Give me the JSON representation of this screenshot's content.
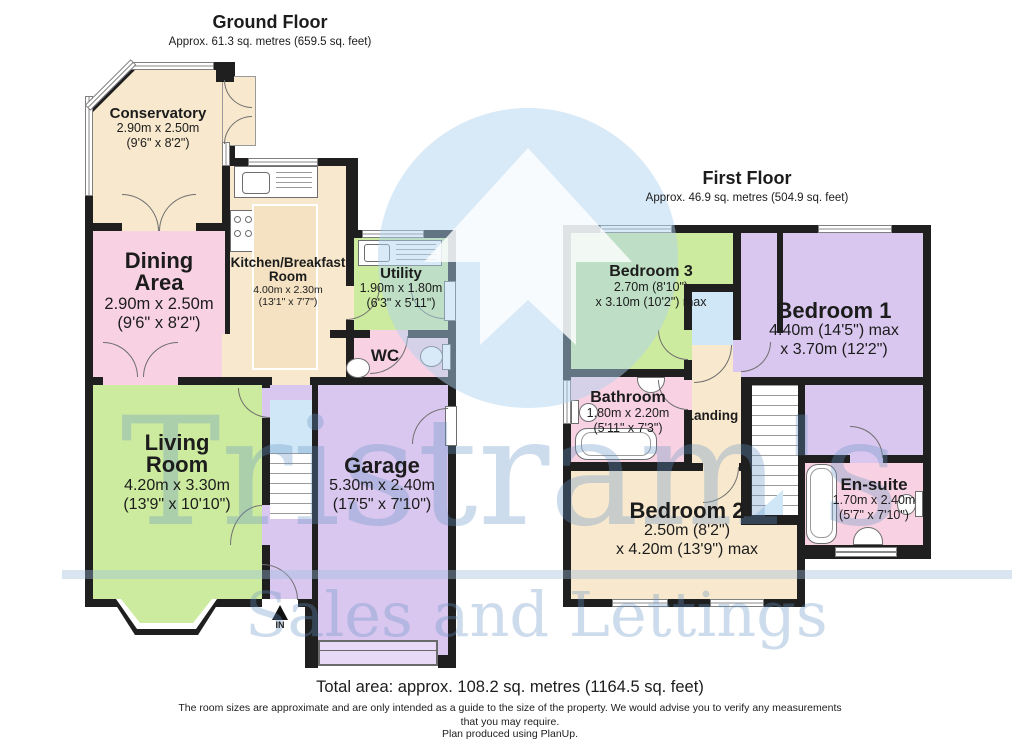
{
  "ground_floor": {
    "title": "Ground Floor",
    "subtitle": "Approx. 61.3 sq. metres (659.5 sq. feet)",
    "entrance_label": "IN",
    "rooms": {
      "conservatory": {
        "name": "Conservatory",
        "l1": "2.90m x 2.50m",
        "l2": "(9'6\" x 8'2\")"
      },
      "dining": {
        "name": "Dining Area",
        "l1": "2.90m x 2.50m",
        "l2": "(9'6\" x 8'2\")"
      },
      "kitchen": {
        "name": "Kitchen/Breakfast Room",
        "l1": "4.00m x 2.30m",
        "l2": "(13'1\" x 7'7\")"
      },
      "utility": {
        "name": "Utility",
        "l1": "1.90m x 1.80m",
        "l2": "(6'3\" x 5'11\")"
      },
      "wc": {
        "name": "WC"
      },
      "living": {
        "name": "Living Room",
        "l1": "4.20m x 3.30m",
        "l2": "(13'9\" x 10'10\")"
      },
      "garage": {
        "name": "Garage",
        "l1": "5.30m x 2.40m",
        "l2": "(17'5\" x 7'10\")"
      }
    }
  },
  "first_floor": {
    "title": "First Floor",
    "subtitle": "Approx. 46.9 sq. metres (504.9 sq. feet)",
    "rooms": {
      "bedroom3": {
        "name": "Bedroom 3",
        "l1": "2.70m (8'10\")",
        "l2": "x 3.10m (10'2\") max"
      },
      "bedroom1": {
        "name": "Bedroom 1",
        "l1": "4.40m (14'5\") max",
        "l2": "x 3.70m (12'2\")"
      },
      "bathroom": {
        "name": "Bathroom",
        "l1": "1.80m x 2.20m",
        "l2": "(5'11\" x 7'3\")"
      },
      "landing": {
        "name": "Landing"
      },
      "bedroom2": {
        "name": "Bedroom 2",
        "l1": "2.50m (8'2\")",
        "l2": "x 4.20m (13'9\") max"
      },
      "ensuite": {
        "name": "En-suite",
        "l1": "1.70m x 2.40m",
        "l2": "(5'7\" x 7'10\")"
      }
    }
  },
  "footer": {
    "total_area": "Total area: approx. 108.2 sq. metres (1164.5 sq. feet)",
    "disclaimer": "The room sizes are approximate and are only intended as a guide to the size of the property. We would advise you to verify any measurements that you may require.",
    "produced_by": "Plan produced using PlanUp."
  },
  "watermark": {
    "brand": "Tristram's",
    "tagline": "Sales and Lettings"
  },
  "colors": {
    "wall": "#1f1f1f",
    "room_cream": "#f8e9ce",
    "room_pink": "#f8d2e2",
    "room_green": "#cdeb9f",
    "room_lavender": "#d9c7ef",
    "stairs_blue": "#cfe7f7",
    "watermark_blue": "#c9dbec"
  },
  "fixtures": {
    "ground_floor": [
      "kitchen-sink-icon",
      "drainer-icon",
      "hob-icon",
      "kitchen-island",
      "utility-sink-icon",
      "toilet-icon",
      "wash-basin-icon",
      "staircase-icon",
      "bay-window",
      "garage-door",
      "entrance-arrow-icon"
    ],
    "first_floor": [
      "bathtub-icon",
      "wash-basin-icon",
      "toilet-icon",
      "staircase-icon",
      "airing-cupboard",
      "ensuite-bathtub-icon",
      "ensuite-basin-icon",
      "ensuite-toilet-icon"
    ]
  }
}
